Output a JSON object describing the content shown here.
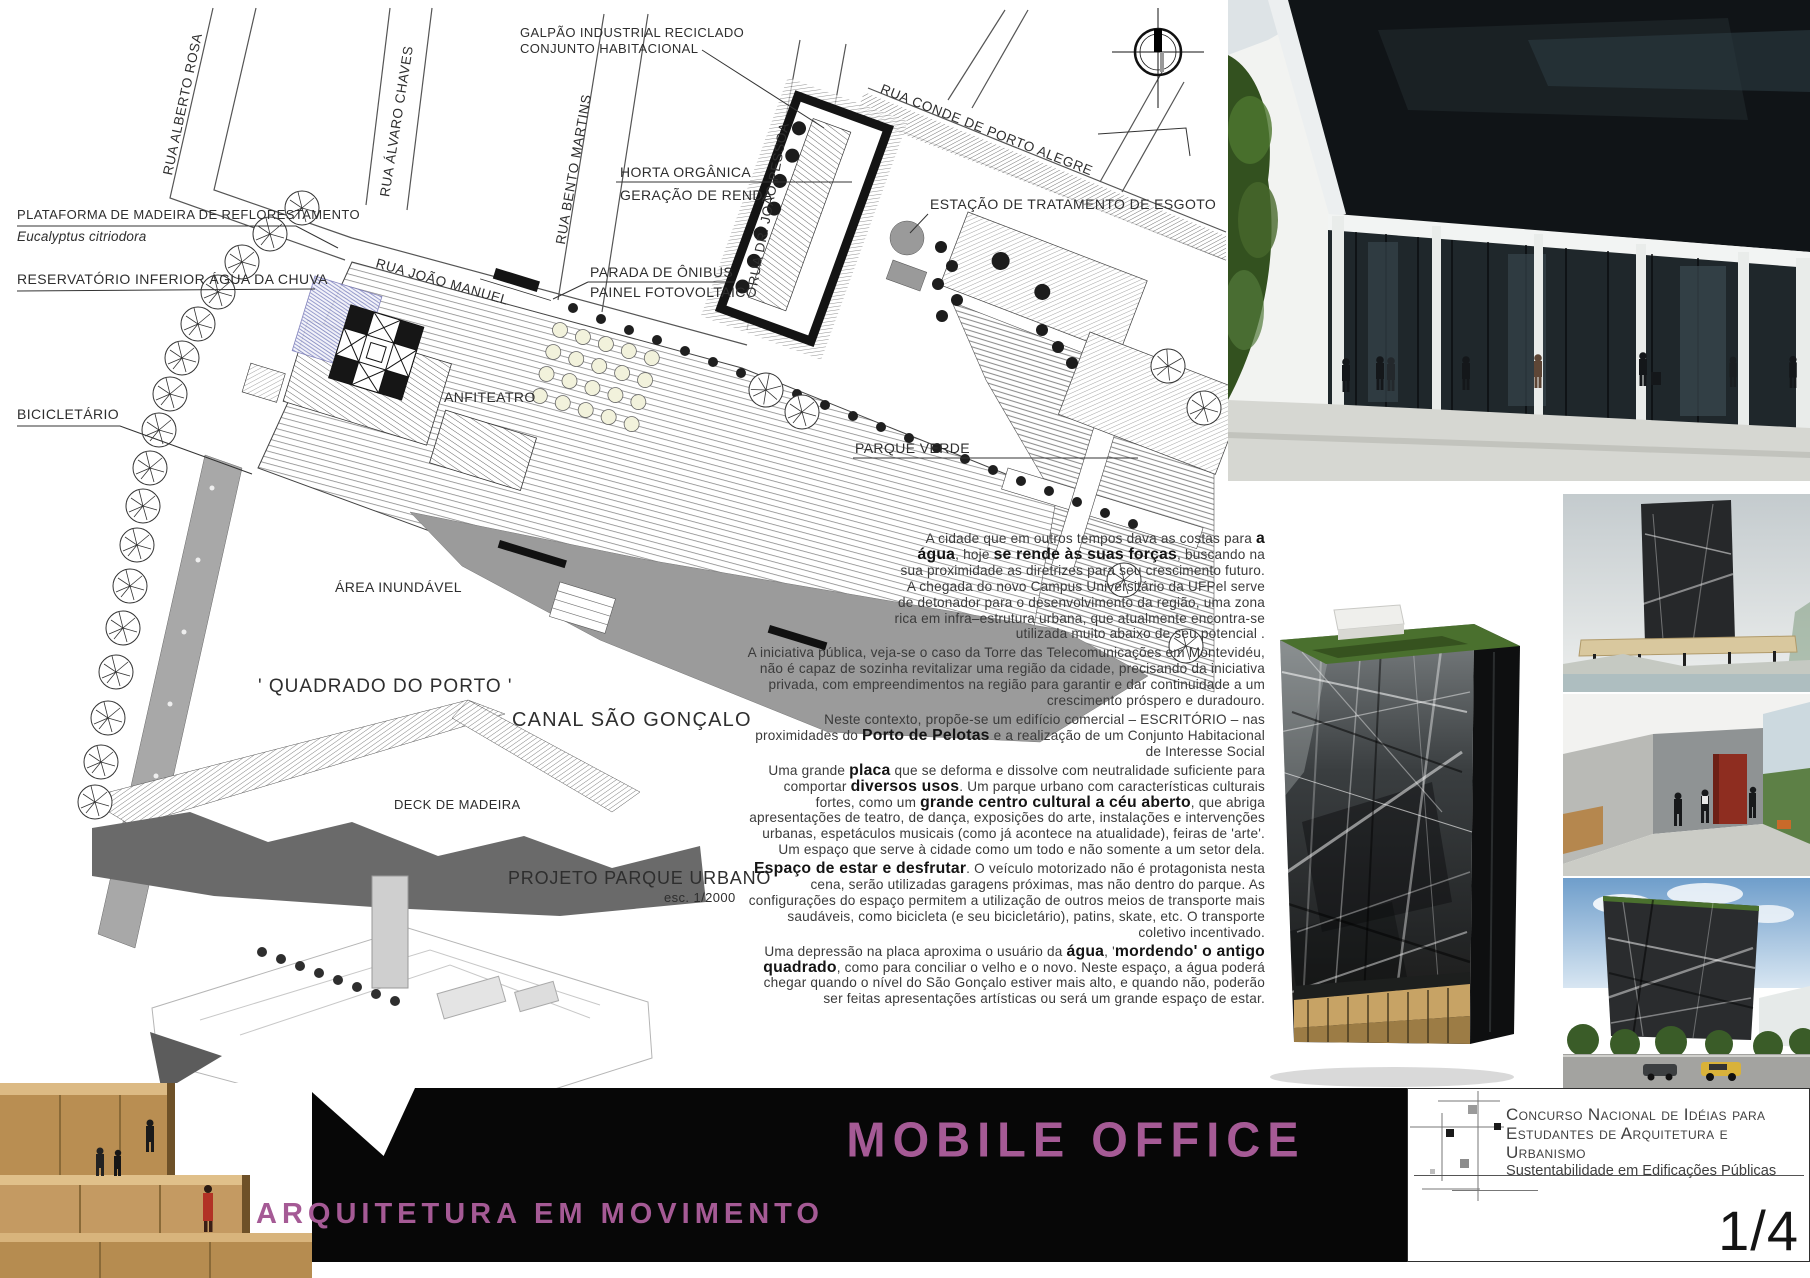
{
  "colors": {
    "accent": "#a55a95",
    "footer_bar": "#070707"
  },
  "plan": {
    "streets": [
      "RUA ALBERTO ROSA",
      "RUA ÁLVARO CHAVES",
      "RUA BENTO MARTINS",
      "RUA JOÃO MANUEL",
      "RUA DR. JOÃO PESSOA",
      "RUA CONDE DE PORTO ALEGRE"
    ],
    "labels": {
      "plataforma": {
        "line1": "PLATAFORMA DE MADEIRA DE REFLORESTAMENTO",
        "line2": "Eucalyptus citriodora"
      },
      "reservatorio": "RESERVATÓRIO INFERIOR ÁGUA DA CHUVA",
      "bicicletario": "BICICLETÁRIO",
      "galpao": {
        "line1": "GALPÃO INDUSTRIAL RECICLADO",
        "line2": "CONJUNTO HABITACIONAL"
      },
      "horta": {
        "line1": "HORTA ORGÂNICA",
        "line2": "GERAÇÃO DE RENDA"
      },
      "estacao": "ESTAÇÃO DE TRATAMENTO DE ESGOTO",
      "parada": {
        "line1": "PARADA DE ÔNIBUS",
        "line2": "PAINEL FOTOVOLTAICO"
      },
      "anfiteatro": "ANFITEATRO",
      "parque_verde": "PARQUE VERDE",
      "area_inundavel": "ÁREA INUNDÁVEL",
      "quadrado": "' QUADRADO DO PORTO '",
      "canal": "CANAL SÃO GONÇALO",
      "deck": "DECK DE MADEIRA",
      "projeto_titulo": "PROJETO PARQUE URBANO",
      "projeto_escala": "esc. 1/2000"
    }
  },
  "text_block": {
    "paragraphs": [
      "A cidade que em outros tempos dava as costas para **a água**, hoje **se rende às suas forças**, buscando na sua proximidade as diretrizes para seu crescimento futuro. A chegada do novo Campus Universitário da UFPel serve de detonador para o desenvolvimento da região, uma zona rica em infra–estrutura urbana, que atualmente encontra-se utilizada muito abaixo de seu potencial .",
      "A iniciativa pública, veja-se o caso da Torre das Telecomunicações em Montevidéu, não é capaz de sozinha revitalizar uma região da cidade, precisando da iniciativa privada, com empreendimentos na região para garantir e dar continuidade a um crescimento próspero e duradouro.",
      "Neste contexto, propõe-se um edifício comercial – ESCRITÓRIO – nas proximidades do **Porto de Pelotas** e a realização de um Conjunto Habitacional de Interesse Social",
      "Uma grande **placa** que se deforma e dissolve com neutralidade suficiente para comportar **diversos usos**. Um parque urbano com características culturais fortes, como um **grande centro cultural a céu aberto**, que abriga apresentações de teatro, de dança,  exposições do arte, instalações e intervenções urbanas, espetáculos musicais (como já acontece na atualidade), feiras de 'arte'. Um espaço que serve à cidade como um todo e não somente a um setor dela.",
      "**Espaço de estar e desfrutar**. O veículo motorizado não é protagonista nesta cena, serão utilizadas garagens próximas, mas não dentro do parque. As configurações do espaço permitem a utilização de outros meios de transporte mais saudáveis, como bicicleta (e seu bicicletário), patins, skate, etc. O transporte coletivo incentivado.",
      "Uma depressão na placa aproxima o usuário da **água**, '**mordendo' o antigo quadrado**, como para conciliar o velho e o novo. Neste espaço, a água poderá chegar quando o nível do São Gonçalo estiver mais alto, e quando não, poderão ser feitas apresentações artísticas ou será um grande espaço de estar."
    ]
  },
  "footer": {
    "title": "MOBILE OFFICE",
    "subtitle": "ARQUITETURA EM MOVIMENTO",
    "competition_line1": "Concurso Nacional de Idéias para",
    "competition_line2": "Estudantes de  Arquitetura e  Urbanismo",
    "competition_line3": "Sustentabilidade em Edificações Públicas",
    "page_number": "1/4"
  }
}
